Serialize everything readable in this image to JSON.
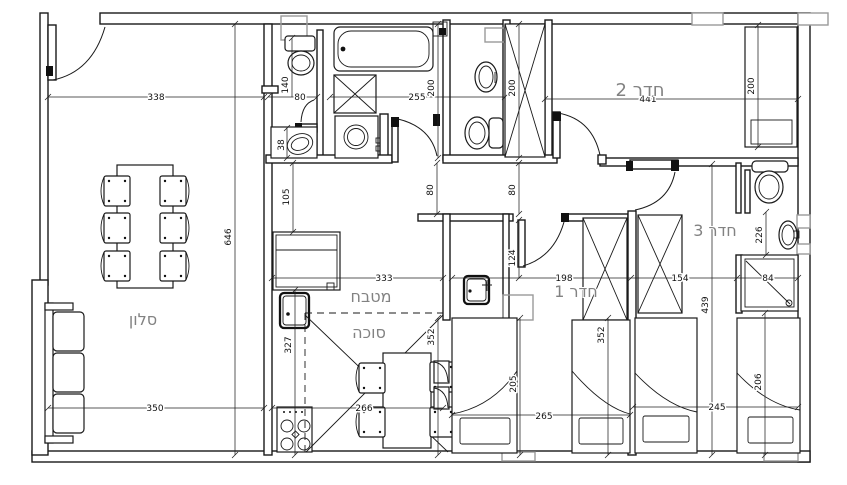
{
  "plan": {
    "rooms": {
      "salon": "סלון",
      "kitchen": "מטבח",
      "sukkah": "סוכה",
      "room1": "חדר 1",
      "room2": "חדר 2",
      "room3": "חדר 3"
    },
    "dims": {
      "d338": "338",
      "d80a": "80",
      "d255": "255",
      "d441": "441",
      "d140": "140",
      "d38": "38",
      "d105": "105",
      "d327": "327",
      "d200a": "200",
      "d200b": "200",
      "d200c": "200",
      "d80b": "80",
      "d80c": "80",
      "d124": "124",
      "d205": "205",
      "d352a": "352",
      "d352b": "352",
      "d646": "646",
      "d439": "439",
      "d226": "226",
      "d206": "206",
      "d333": "333",
      "d198": "198",
      "d154": "154",
      "d84": "84",
      "d350": "350",
      "d266": "266",
      "d265": "265",
      "d245": "245"
    }
  }
}
